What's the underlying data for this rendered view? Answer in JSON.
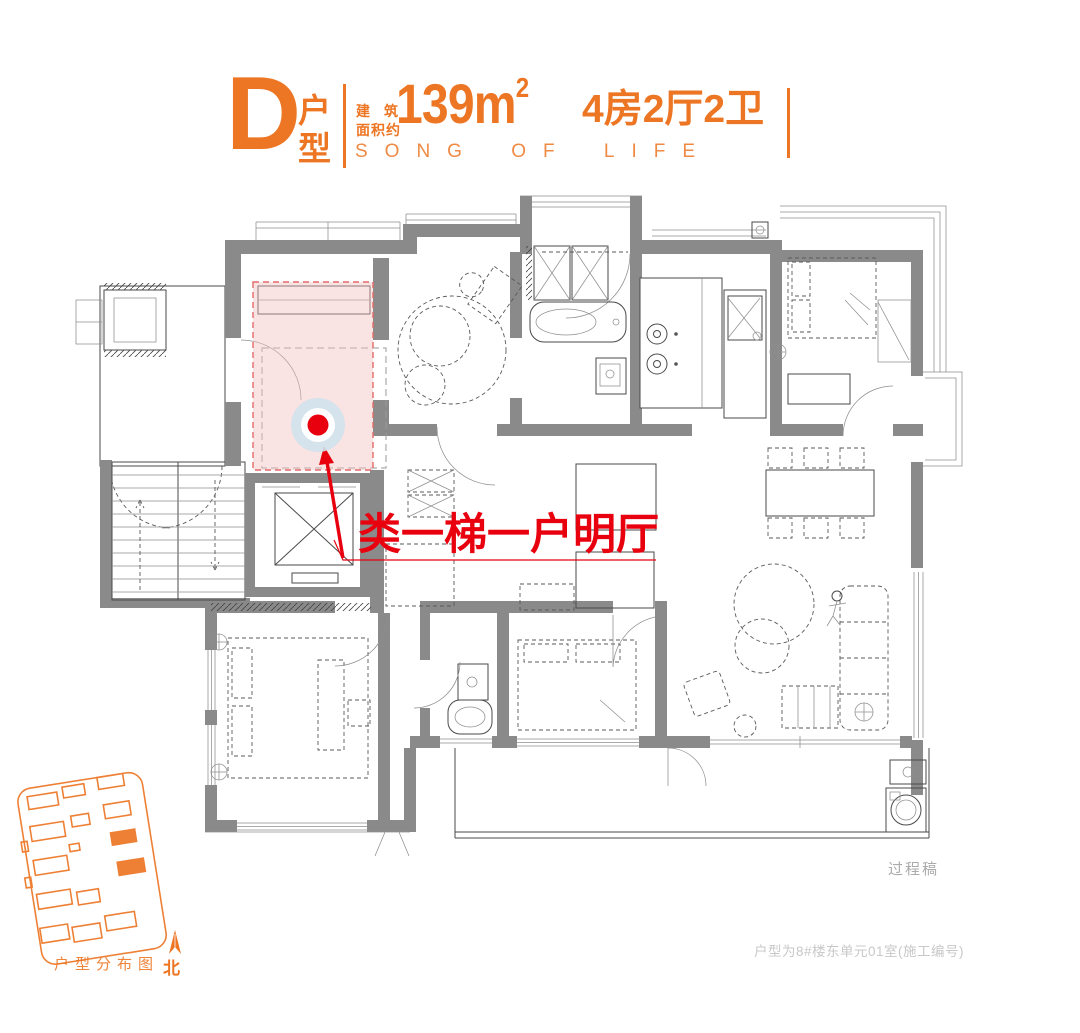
{
  "colors": {
    "accent": "#ED7624",
    "highlight_red": "#E8000F",
    "pink_fill": "#F6CFCF",
    "wall_gray": "#8A8A8A"
  },
  "header": {
    "unit_letter": "D",
    "unit_label_top": "户",
    "unit_label_bottom": "型",
    "area_prefix_line1": "建筑",
    "area_prefix_line2": "面积约",
    "area_value": "139m",
    "area_sup": "2",
    "rooms_label": "4房2厅2卫",
    "slogan": "SONG OF LIFE"
  },
  "annotation": {
    "highlight_label": "类一梯一户明厅"
  },
  "footer": {
    "draft_note": "过程稿",
    "unit_note": "户型为8#楼东单元01室(施工编号)",
    "sitemap_caption": "户型分布图",
    "north_label": "北"
  }
}
